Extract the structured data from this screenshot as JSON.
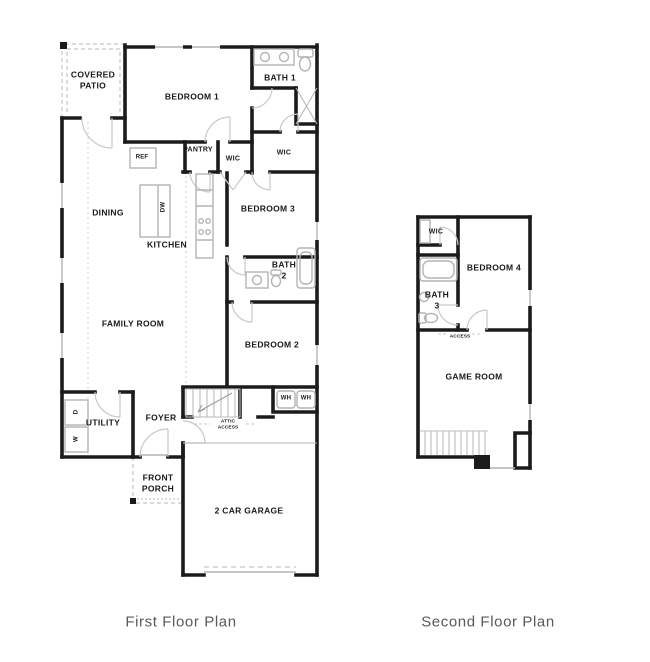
{
  "captions": {
    "first": "First Floor Plan",
    "second": "Second Floor Plan"
  },
  "first_floor": {
    "covered_patio": "COVERED\nPATIO",
    "bedroom1": "BEDROOM 1",
    "bath1": "BATH 1",
    "ref": "REF",
    "pantry": "PANTRY",
    "wic_hall": "WIC",
    "wic_bath1": "WIC",
    "dining": "DINING",
    "dw": "DW",
    "kitchen": "KITCHEN",
    "bedroom3": "BEDROOM 3",
    "bath2": "BATH\n2",
    "family_room": "FAMILY ROOM",
    "bedroom2": "BEDROOM 2",
    "utility": "UTILITY",
    "dryer": "D",
    "washer": "W",
    "foyer": "FOYER",
    "wh_left": "WH",
    "wh_right": "WH",
    "attic_access": "ATTIC\nACCESS",
    "front_porch": "FRONT\nPORCH",
    "garage": "2 CAR GARAGE"
  },
  "second_floor": {
    "wic": "WIC",
    "bedroom4": "BEDROOM 4",
    "bath3": "BATH\n3",
    "attic_access": "ATTIC\nACCESS",
    "game_room": "GAME ROOM"
  },
  "colors": {
    "wall": "#1b1b1b",
    "fixture": "#b4b4b4",
    "door": "#c9c9c9",
    "caption_text": "#58595b",
    "background": "#ffffff"
  }
}
